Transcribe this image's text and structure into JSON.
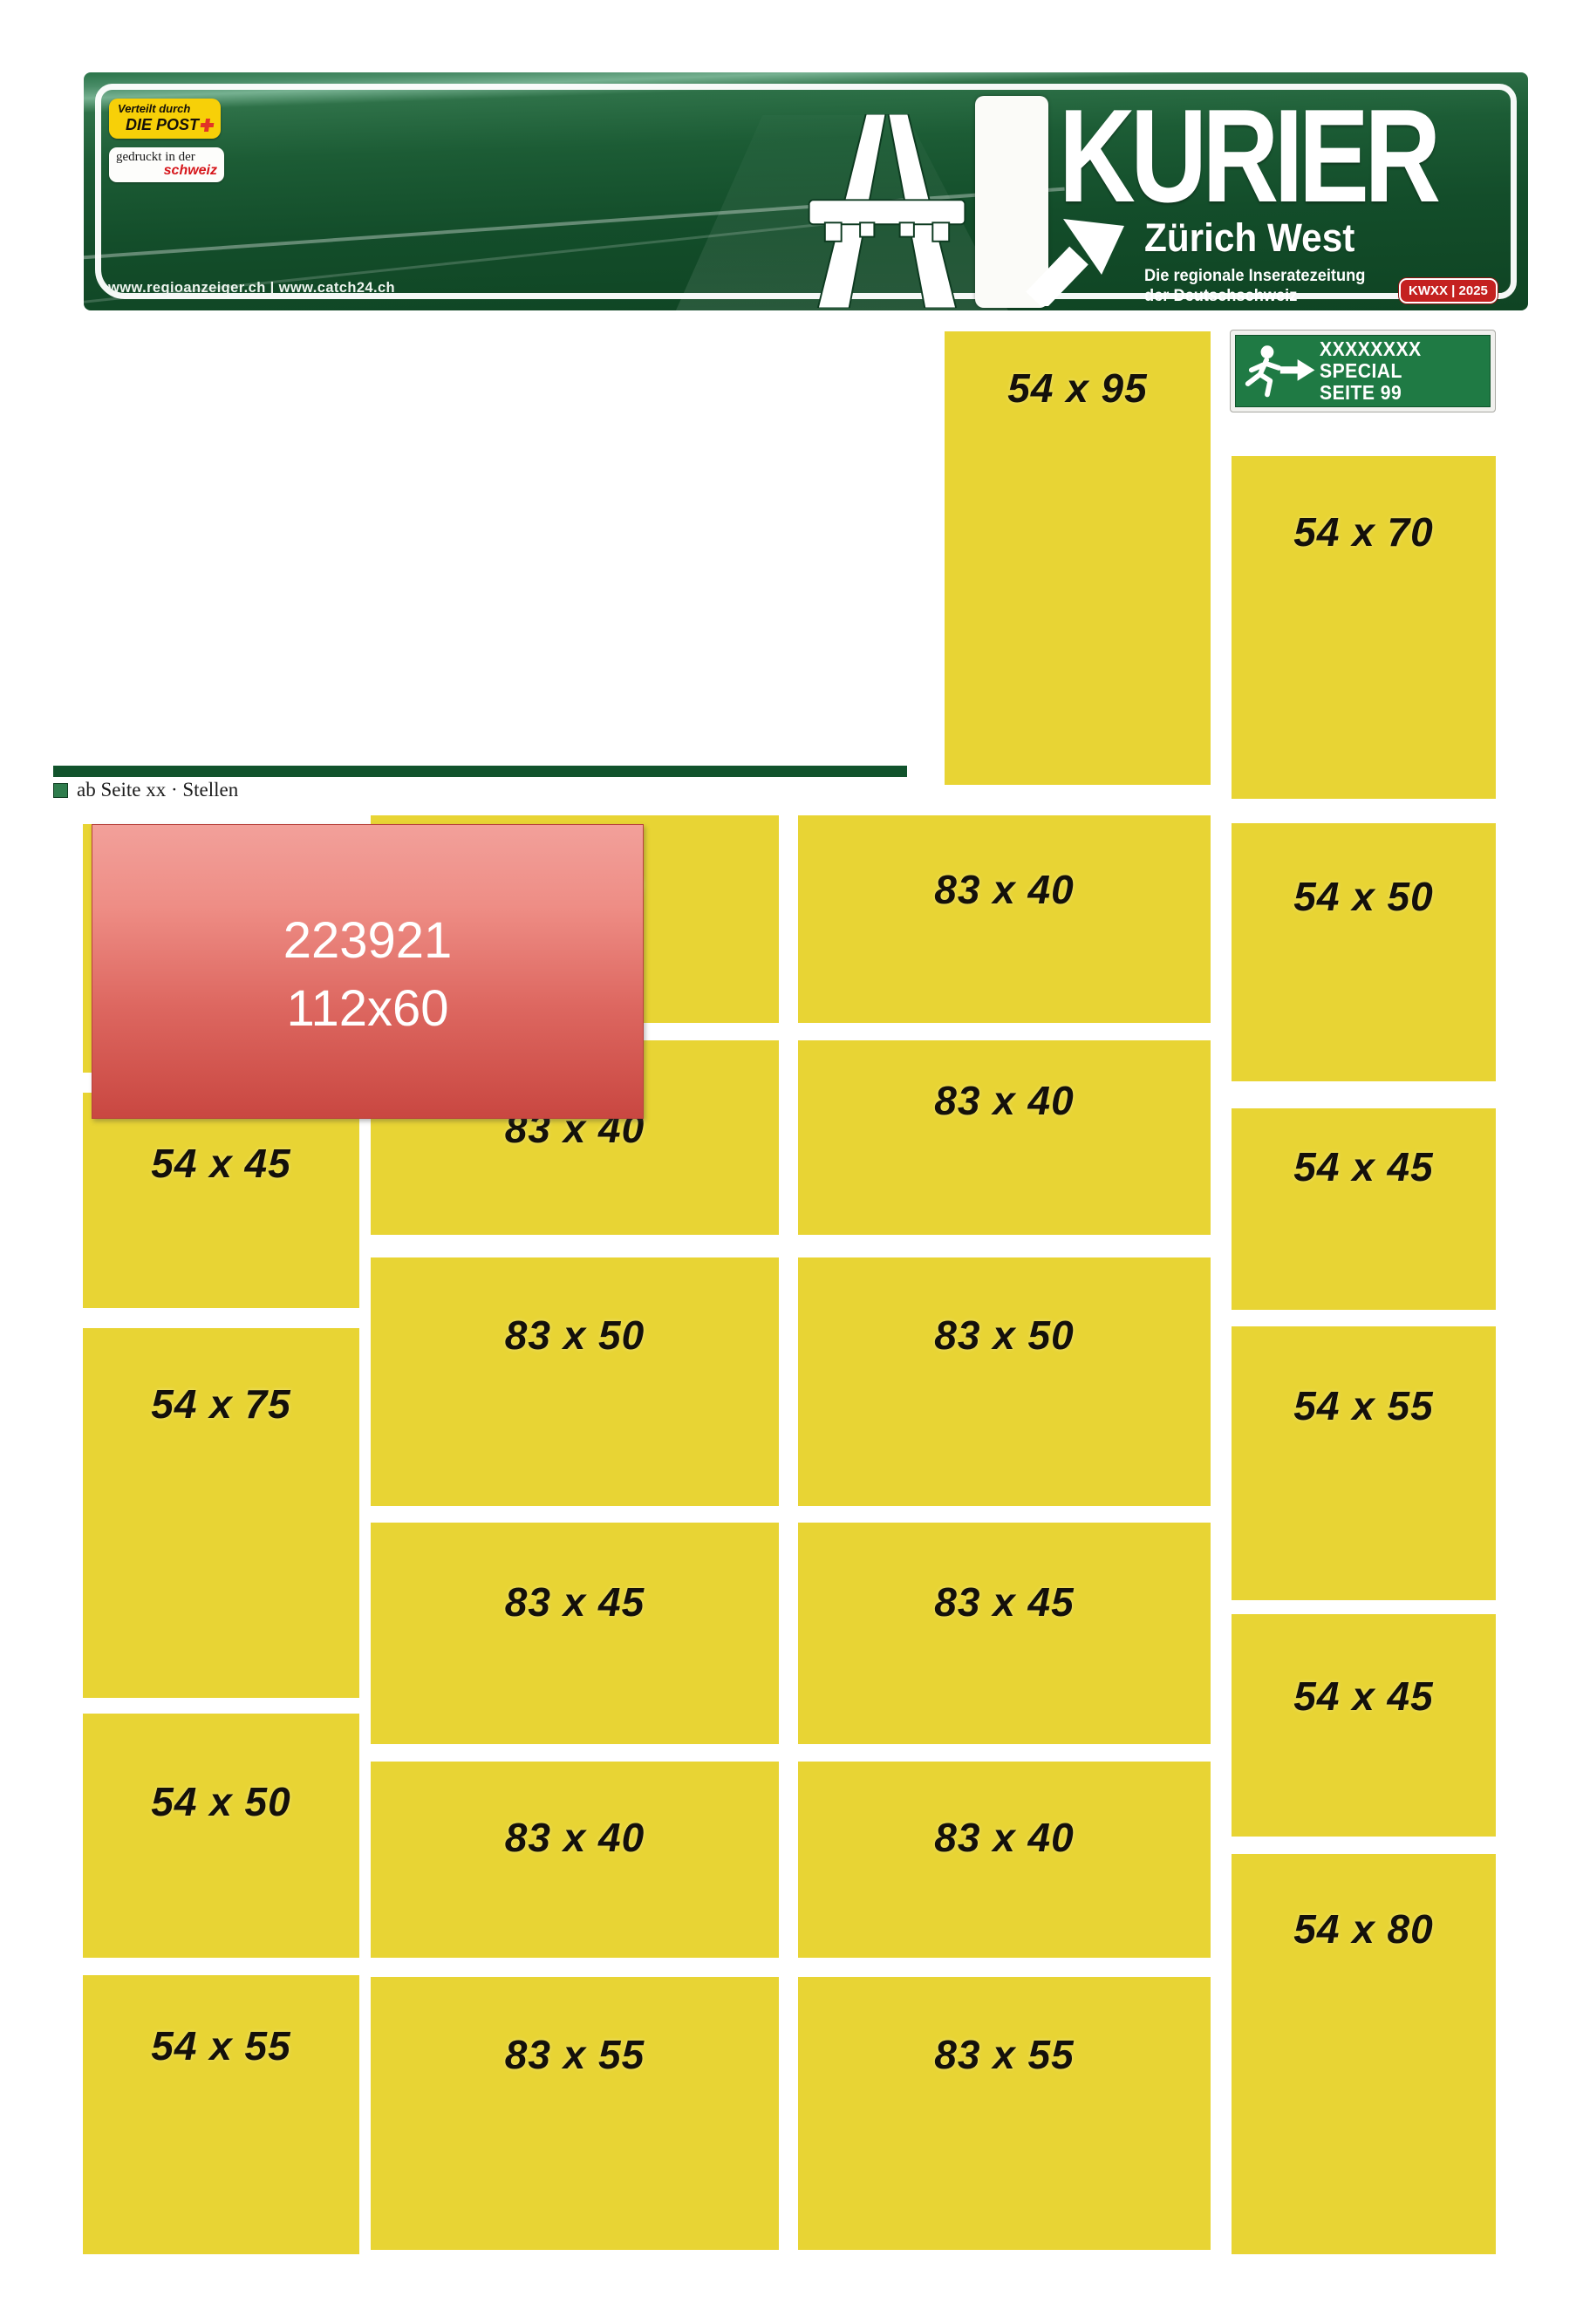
{
  "banner": {
    "title": "KURIER",
    "region": "Zürich West",
    "tagline_line1": "Die regionale Inseratezeitung",
    "tagline_line2": "der Deutschschweiz",
    "week_badge": "KWXX | 2025",
    "post_badge_line1": "Verteilt durch",
    "post_badge_line2": "DIE POST",
    "print_badge_line1": "gedruckt in der",
    "print_badge_line2": "schweiz",
    "urls": "www.regioanzeiger.ch | www.catch24.ch"
  },
  "special_sign": {
    "line1": "XXXXXXXX",
    "line2": "SPECIAL",
    "line3": "SEITE 99"
  },
  "section": {
    "label": "ab Seite xx · Stellen"
  },
  "overlay": {
    "line1": "223921",
    "line2": "112x60"
  },
  "ad_slots": [
    {
      "label": "54 x 95"
    },
    {
      "label": "54 x 70"
    },
    {
      "label": "54 x 50"
    },
    {
      "label": "54 x 45"
    },
    {
      "label": "54 x 55"
    },
    {
      "label": "54 x 45"
    },
    {
      "label": "54 x 80"
    },
    {
      "label": ""
    },
    {
      "label": "54 x 45"
    },
    {
      "label": "54 x 75"
    },
    {
      "label": "54 x 50"
    },
    {
      "label": "54 x 55"
    },
    {
      "label": "83 x 40"
    },
    {
      "label": "83 x 40"
    },
    {
      "label": "83 x 50"
    },
    {
      "label": "83 x 45"
    },
    {
      "label": "83 x 40"
    },
    {
      "label": "83 x 55"
    },
    {
      "label": "83 x 40"
    },
    {
      "label": "83 x 40"
    },
    {
      "label": "83 x 50"
    },
    {
      "label": "83 x 45"
    },
    {
      "label": "83 x 40"
    },
    {
      "label": "83 x 55"
    }
  ],
  "colors": {
    "slot_yellow": "#e8d434",
    "slot_label_black": "#14100a",
    "banner_green_dark": "#134d2a",
    "banner_green_light": "#76b191",
    "overlay_red_top": "#f2a09a",
    "overlay_red_bottom": "#c94741",
    "exit_sign_green": "#1f7a44",
    "week_badge_red": "#c42120",
    "post_badge_yellow": "#f7d008",
    "schweiz_red": "#d6171c",
    "divider_green": "#11532c"
  }
}
